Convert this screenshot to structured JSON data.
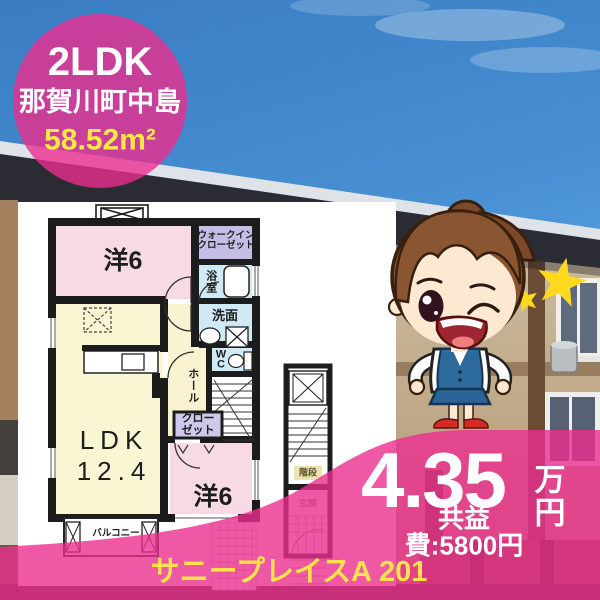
{
  "badge": {
    "layout": "2LDK",
    "location": "那賀川町中島",
    "area": "58.52m²"
  },
  "floorplan": {
    "room1": "洋6",
    "walk_in_closet": "ウォークイン\nクローゼット",
    "bath": "浴室",
    "washroom": "洗面",
    "wc": "W\nC",
    "hall": "ホール",
    "closet": "クロー\nゼット",
    "ldk": "LDK\n12.4",
    "room2": "洋6",
    "balcony": "バルコニー",
    "stairs": "階段",
    "entrance": "玄関"
  },
  "price": {
    "rent_value": "4.35",
    "rent_unit": "万円",
    "common_fee": "共益費:5800円"
  },
  "property_name": "サニープレイスA 201",
  "colors": {
    "accent_pink": "#eb2e8f",
    "badge_yellow": "#ffe845",
    "name_yellow": "#ffe24c",
    "room_pink": "#f8d9e6",
    "ldk_cream": "#faf5d3",
    "closet_lavender": "#c6bde7",
    "wet_blue": "#cfe9f5"
  }
}
